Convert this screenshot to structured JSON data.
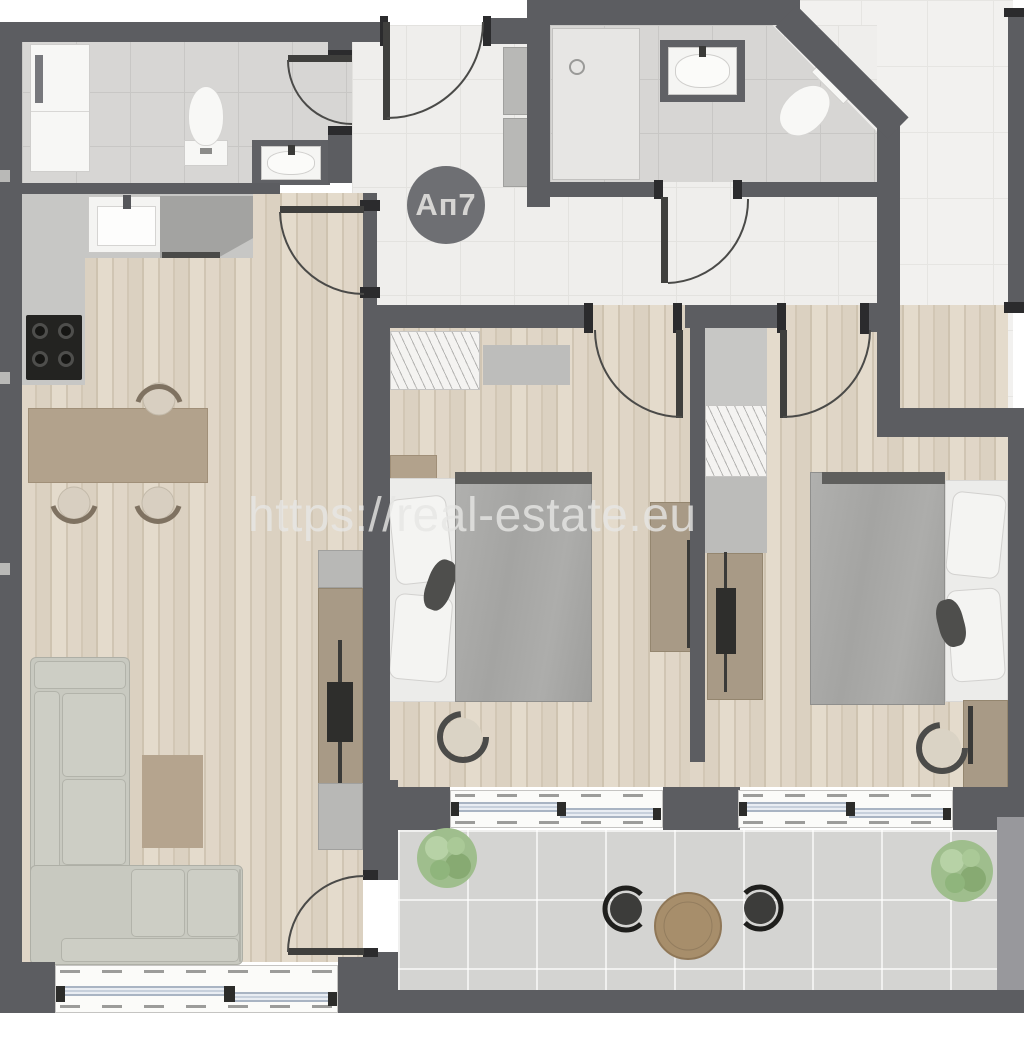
{
  "unit_badge": {
    "label": "Ап7"
  },
  "watermark": {
    "text": "https://real-estate.eu"
  },
  "colors": {
    "wall": "#5c5d61",
    "wall_cap": "#2b2b2d",
    "wood_floor": "#d9cfc0",
    "hall_tile": "#efeeec",
    "bath_tile": "#d7d6d4",
    "terrace_tile": "#d4d4d2",
    "badge_bg": "#6e6f73",
    "badge_text": "#d6d5d3",
    "watermark_text": "#e7e7e5",
    "sofa": "#c8c9c0",
    "dining_table": "#b2a28c",
    "duvet": "#a9a9a7",
    "dresser": "#a89a86",
    "tv": "#2e2e2c",
    "plant": "#9fbe8d",
    "terrace_table": "#a78e6b",
    "terrace_chair": "#3c3c3a",
    "window_glass": "#a9b4c3"
  },
  "icons": {
    "unit-badge": "dark-circle-with-label",
    "watermark": "translucent-text-overlay",
    "plant-icon": "layered-green-circles",
    "door-icon": "leaf-with-quarter-arc",
    "window-icon": "double-pane-glass-lines",
    "toilet-icon": "tank-plus-bowl",
    "sink-icon": "basin-with-faucet",
    "shower-icon": "tray-with-head",
    "cooktop-icon": "black-panel-4-burners",
    "tv-icon": "dark-bar-on-console",
    "bed-icon": "duvet-with-pillows",
    "sofa-icon": "L-shaped-cushions",
    "chair-icon": "round-seat-with-back-arc",
    "table-icon": "round-wood-top"
  }
}
